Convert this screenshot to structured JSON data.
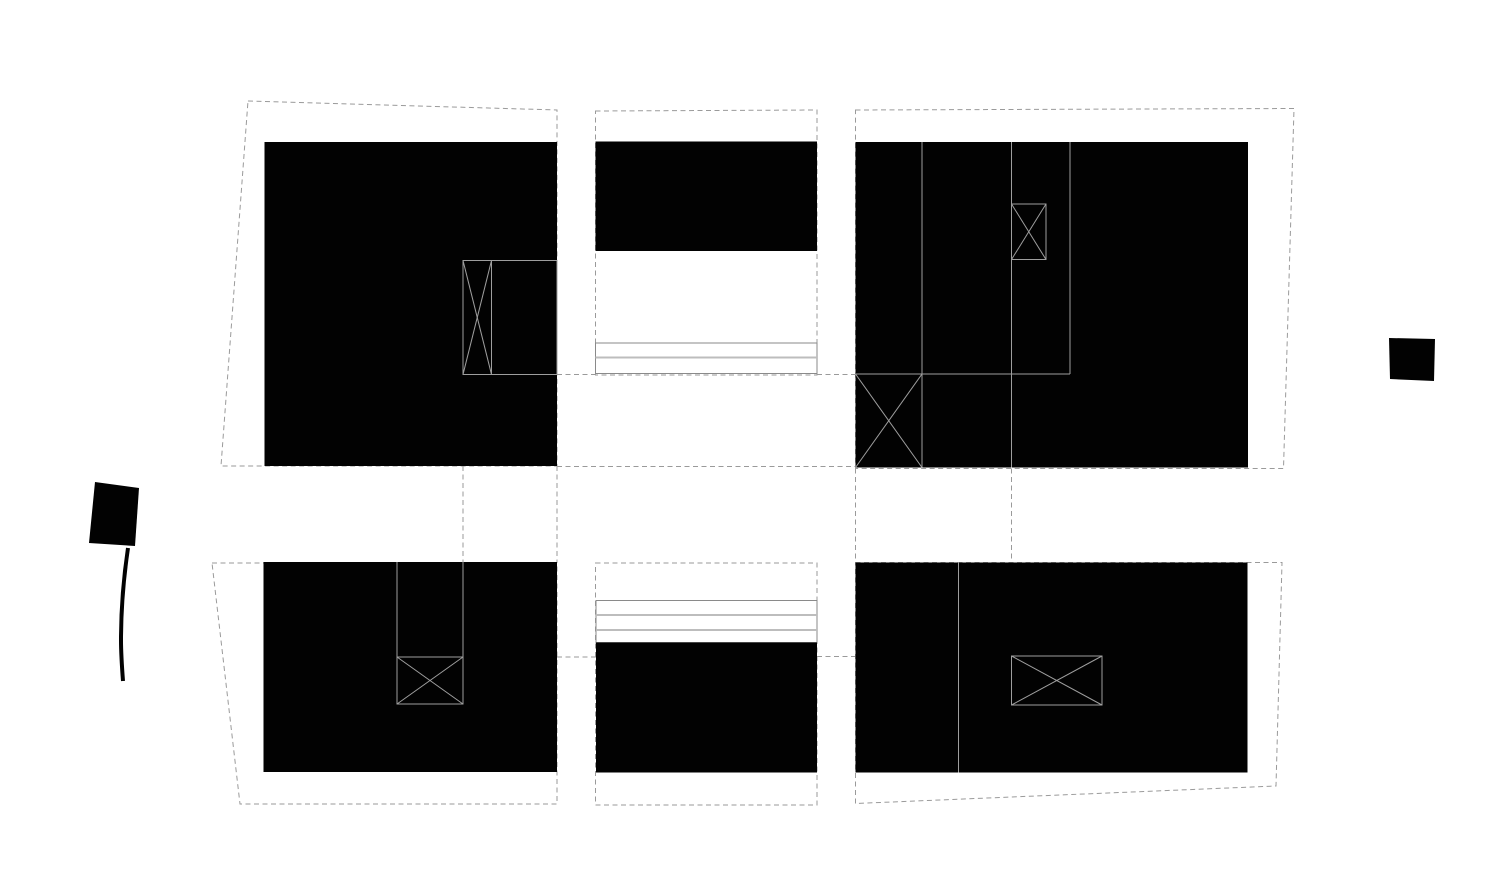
{
  "canvas": {
    "width": 1512,
    "height": 894,
    "background": "#ffffff"
  },
  "colors": {
    "building_mass": "#020202",
    "parcel_dashed_line": "#9a9a9a",
    "detail_line": "#9e9e9e",
    "step_strip_outline": "#8a8a8a",
    "step_strip_inner": "#bdbdbd"
  },
  "elements": [
    {
      "type": "polygon",
      "class": "dashed",
      "name": "parcel-boundary-top-left",
      "attrs": {
        "points": "248,101 557,110 557,466 221,466"
      }
    },
    {
      "type": "polygon",
      "class": "dashed",
      "name": "parcel-boundary-top-middle",
      "attrs": {
        "points": "595.5,111 817,110 817,375 595.5,375"
      }
    },
    {
      "type": "polygon",
      "class": "dashed",
      "name": "parcel-boundary-top-right",
      "attrs": {
        "points": "855.5,110 1294,108.5 1283.5,468.5 855.5,468.5"
      }
    },
    {
      "type": "polygon",
      "class": "dashed",
      "name": "parcel-boundary-bottom-left",
      "attrs": {
        "points": "212,563 557,563 557,804 240,804"
      }
    },
    {
      "type": "polygon",
      "class": "dashed",
      "name": "parcel-boundary-bottom-middle",
      "attrs": {
        "points": "595.5,563 817,563 817,805 595.5,805"
      }
    },
    {
      "type": "polygon",
      "class": "dashed",
      "name": "parcel-boundary-bottom-right",
      "attrs": {
        "points": "855.5,562.5 1282,562.5 1276,786 855.5,803.5"
      }
    },
    {
      "type": "line",
      "class": "dashed",
      "name": "tie-line-horizontal-mid-upper",
      "attrs": {
        "x1": "557",
        "y1": "466.5",
        "x2": "855.5",
        "y2": "466.5"
      }
    },
    {
      "type": "line",
      "class": "dashed",
      "name": "tie-line-vertical-left-a",
      "attrs": {
        "x1": "463",
        "y1": "466",
        "x2": "463",
        "y2": "562"
      }
    },
    {
      "type": "line",
      "class": "dashed",
      "name": "tie-line-vertical-left-b",
      "attrs": {
        "x1": "557",
        "y1": "466",
        "x2": "557",
        "y2": "563"
      }
    },
    {
      "type": "line",
      "class": "dashed",
      "name": "tie-line-vertical-right-a",
      "attrs": {
        "x1": "855.5",
        "y1": "468.5",
        "x2": "855.5",
        "y2": "562.5"
      }
    },
    {
      "type": "line",
      "class": "dashed",
      "name": "tie-line-vertical-right-b",
      "attrs": {
        "x1": "1011.5",
        "y1": "468.5",
        "x2": "1011.5",
        "y2": "562.5"
      }
    },
    {
      "type": "line",
      "class": "dashed",
      "name": "tie-line-h374-west",
      "attrs": {
        "x1": "557",
        "y1": "374.5",
        "x2": "595.5",
        "y2": "374.5"
      }
    },
    {
      "type": "line",
      "class": "dashed",
      "name": "tie-line-h374-east",
      "attrs": {
        "x1": "817",
        "y1": "374.5",
        "x2": "855.5",
        "y2": "374.5"
      }
    },
    {
      "type": "line",
      "class": "dashed",
      "name": "tie-line-h657-west",
      "attrs": {
        "x1": "557",
        "y1": "657",
        "x2": "596",
        "y2": "657"
      }
    },
    {
      "type": "line",
      "class": "dashed",
      "name": "tie-line-h657-east",
      "attrs": {
        "x1": "817",
        "y1": "656.5",
        "x2": "855.5",
        "y2": "656.5"
      }
    },
    {
      "type": "rect",
      "class": "strip-outline",
      "name": "steps-strip-top-middle",
      "attrs": {
        "x": "595.5",
        "y": "343",
        "width": "221.5",
        "height": "30.5"
      }
    },
    {
      "type": "line",
      "class": "strip-inner",
      "name": "steps-strip-top-inner-line",
      "attrs": {
        "x1": "595.5",
        "y1": "357.5",
        "x2": "817",
        "y2": "357.5"
      }
    },
    {
      "type": "rect",
      "class": "strip-outline",
      "name": "steps-strip-bottom-middle",
      "attrs": {
        "x": "596",
        "y": "600.5",
        "width": "221",
        "height": "42"
      }
    },
    {
      "type": "line",
      "class": "strip-inner",
      "name": "steps-strip-bottom-inner-line-1",
      "attrs": {
        "x1": "596",
        "y1": "615",
        "x2": "817",
        "y2": "615"
      }
    },
    {
      "type": "line",
      "class": "strip-inner",
      "name": "steps-strip-bottom-inner-line-2",
      "attrs": {
        "x1": "596",
        "y1": "630",
        "x2": "817",
        "y2": "630"
      }
    },
    {
      "type": "rect",
      "class": "mass",
      "name": "building-mass-top-left",
      "attrs": {
        "x": "264.5",
        "y": "142",
        "width": "292.5",
        "height": "324"
      }
    },
    {
      "type": "rect",
      "class": "mass",
      "name": "building-mass-top-middle",
      "attrs": {
        "x": "595.5",
        "y": "141.5",
        "width": "221.5",
        "height": "109.5"
      }
    },
    {
      "type": "rect",
      "class": "mass",
      "name": "building-mass-top-right",
      "attrs": {
        "x": "855.5",
        "y": "142",
        "width": "392.5",
        "height": "325.5"
      }
    },
    {
      "type": "rect",
      "class": "mass",
      "name": "building-mass-bottom-left",
      "attrs": {
        "x": "263.5",
        "y": "562",
        "width": "293.5",
        "height": "210"
      }
    },
    {
      "type": "rect",
      "class": "mass",
      "name": "building-mass-bottom-middle",
      "attrs": {
        "x": "596",
        "y": "642.5",
        "width": "221",
        "height": "130"
      }
    },
    {
      "type": "rect",
      "class": "mass",
      "name": "building-mass-bottom-right",
      "attrs": {
        "x": "855.5",
        "y": "562.5",
        "width": "392",
        "height": "210"
      }
    },
    {
      "type": "polygon",
      "class": "mass",
      "name": "flag-symbol-west",
      "attrs": {
        "points": "95,482 139,488 135,546 89,543"
      }
    },
    {
      "type": "path",
      "class": "tail",
      "name": "flag-symbol-west-tail",
      "attrs": {
        "d": "M128,548 C124,575 121,610 121,640 C121,655 122,668 123,681"
      }
    },
    {
      "type": "polygon",
      "class": "mass",
      "name": "small-block-east",
      "attrs": {
        "points": "1389,338 1435,339 1434,381 1390,379"
      }
    },
    {
      "type": "rect",
      "class": "detail",
      "name": "stair-core-top-left-outline",
      "attrs": {
        "x": "463",
        "y": "260.5",
        "width": "94",
        "height": "114"
      }
    },
    {
      "type": "line",
      "class": "detail",
      "name": "stair-core-top-left-divider",
      "attrs": {
        "x1": "491.5",
        "y1": "260.5",
        "x2": "491.5",
        "y2": "374.5"
      }
    },
    {
      "type": "line",
      "class": "detail",
      "name": "stair-core-top-left-diag-1",
      "attrs": {
        "x1": "463",
        "y1": "260.5",
        "x2": "491.5",
        "y2": "374.5"
      }
    },
    {
      "type": "line",
      "class": "detail",
      "name": "stair-core-top-left-diag-2",
      "attrs": {
        "x1": "491.5",
        "y1": "260.5",
        "x2": "463",
        "y2": "374.5"
      }
    },
    {
      "type": "line",
      "class": "detail",
      "name": "top-right-partition-line-1",
      "attrs": {
        "x1": "922",
        "y1": "142",
        "x2": "922",
        "y2": "467.5"
      }
    },
    {
      "type": "line",
      "class": "detail",
      "name": "top-right-partition-line-2",
      "attrs": {
        "x1": "1011.5",
        "y1": "142",
        "x2": "1011.5",
        "y2": "467.5"
      }
    },
    {
      "type": "line",
      "class": "detail",
      "name": "top-right-partition-line-3",
      "attrs": {
        "x1": "1070",
        "y1": "142",
        "x2": "1070",
        "y2": "374"
      }
    },
    {
      "type": "line",
      "class": "detail",
      "name": "top-right-partition-line-4",
      "attrs": {
        "x1": "855.5",
        "y1": "374",
        "x2": "1070",
        "y2": "374"
      }
    },
    {
      "type": "rect",
      "class": "detail",
      "name": "stair-core-top-right-outline",
      "attrs": {
        "x": "1011.5",
        "y": "204",
        "width": "34.5",
        "height": "55.5"
      }
    },
    {
      "type": "line",
      "class": "detail",
      "name": "stair-core-top-right-diag-1",
      "attrs": {
        "x1": "1011.5",
        "y1": "204",
        "x2": "1046",
        "y2": "259.5"
      }
    },
    {
      "type": "line",
      "class": "detail",
      "name": "stair-core-top-right-diag-2",
      "attrs": {
        "x1": "1046",
        "y1": "204",
        "x2": "1011.5",
        "y2": "259.5"
      }
    },
    {
      "type": "line",
      "class": "detail",
      "name": "stair-corner-top-right-diag-1",
      "attrs": {
        "x1": "855.5",
        "y1": "374",
        "x2": "922",
        "y2": "467.5"
      }
    },
    {
      "type": "line",
      "class": "detail",
      "name": "stair-corner-top-right-diag-2",
      "attrs": {
        "x1": "922",
        "y1": "374",
        "x2": "855.5",
        "y2": "467.5"
      }
    },
    {
      "type": "line",
      "class": "detail",
      "name": "shaft-bottom-left-line-1",
      "attrs": {
        "x1": "397",
        "y1": "562",
        "x2": "397",
        "y2": "657"
      }
    },
    {
      "type": "line",
      "class": "detail",
      "name": "shaft-bottom-left-line-2",
      "attrs": {
        "x1": "463",
        "y1": "562",
        "x2": "463",
        "y2": "657"
      }
    },
    {
      "type": "rect",
      "class": "detail",
      "name": "stair-core-bottom-left-outline",
      "attrs": {
        "x": "397",
        "y": "657",
        "width": "66",
        "height": "47"
      }
    },
    {
      "type": "line",
      "class": "detail",
      "name": "stair-core-bottom-left-diag-1",
      "attrs": {
        "x1": "397",
        "y1": "657",
        "x2": "463",
        "y2": "704"
      }
    },
    {
      "type": "line",
      "class": "detail",
      "name": "stair-core-bottom-left-diag-2",
      "attrs": {
        "x1": "463",
        "y1": "657",
        "x2": "397",
        "y2": "704"
      }
    },
    {
      "type": "line",
      "class": "detail",
      "name": "bottom-right-partition-line",
      "attrs": {
        "x1": "958.5",
        "y1": "562.5",
        "x2": "958.5",
        "y2": "772.5"
      }
    },
    {
      "type": "rect",
      "class": "detail",
      "name": "stair-core-bottom-right-outline",
      "attrs": {
        "x": "1011.5",
        "y": "656",
        "width": "90.5",
        "height": "49"
      }
    },
    {
      "type": "line",
      "class": "detail",
      "name": "stair-core-bottom-right-diag-1",
      "attrs": {
        "x1": "1011.5",
        "y1": "656",
        "x2": "1102",
        "y2": "705"
      }
    },
    {
      "type": "line",
      "class": "detail",
      "name": "stair-core-bottom-right-diag-2",
      "attrs": {
        "x1": "1102",
        "y1": "656",
        "x2": "1011.5",
        "y2": "705"
      }
    }
  ]
}
